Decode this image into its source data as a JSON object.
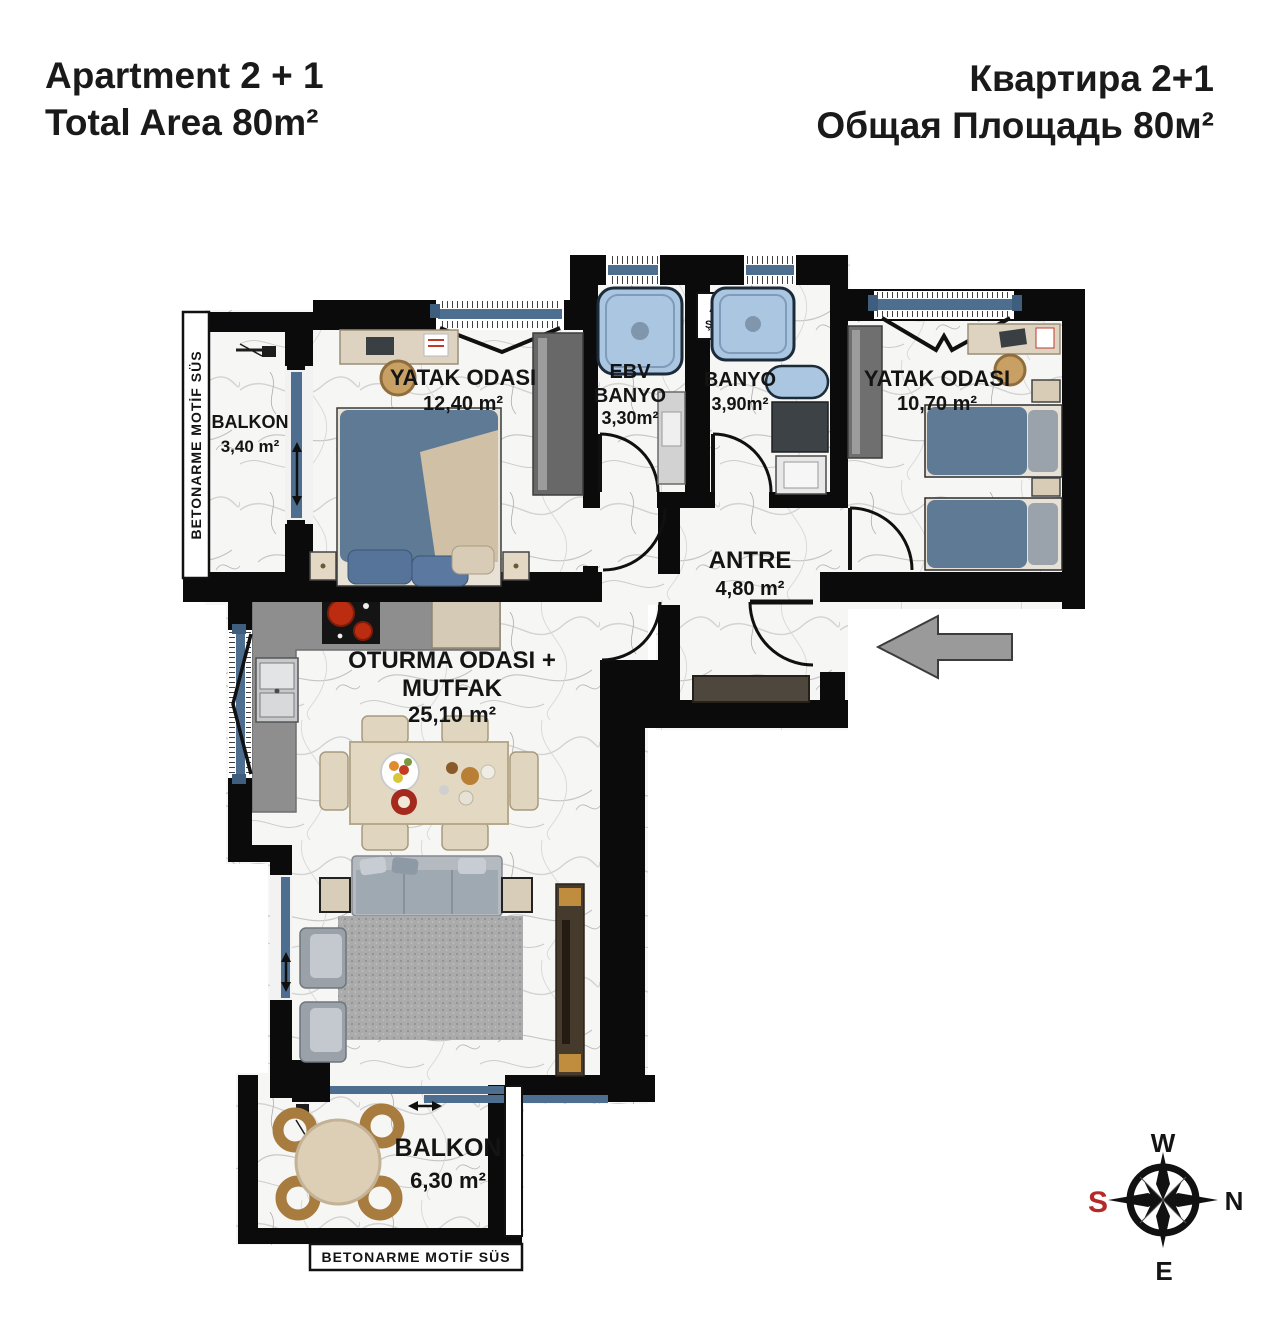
{
  "header": {
    "title_en_line1": "Apartment 2 + 1",
    "title_en_line2": "Total Area 80m²",
    "title_ru_line1": "Квартира 2+1",
    "title_ru_line2": "Общая Площадь 80м²"
  },
  "rooms": {
    "balcony_top": {
      "name": "BALKON",
      "area": "3,40 m²"
    },
    "bedroom_left": {
      "name": "YATAK ODASI",
      "area": "12,40 m²"
    },
    "ensuite_bath": {
      "line1": "EBV",
      "line2": "BANYO",
      "area": "3,30m²"
    },
    "bath": {
      "name": "BANYO",
      "area": "3,90m²"
    },
    "bedroom_right": {
      "name": "YATAK ODASI",
      "area": "10,70 m²"
    },
    "hallway": {
      "name": "ANTRE",
      "area": "4,80 m²"
    },
    "living_kitchen": {
      "line1": "OTURMA ODASI +",
      "line2": "MUTFAK",
      "area": "25,10 m²"
    },
    "balcony_bottom": {
      "name": "BALKON",
      "area": "6,30 m²"
    }
  },
  "decor": {
    "strip_left": "BETONARME MOTİF SÜS",
    "strip_bottom": "BETONARME MOTİF SÜS",
    "shaft_line1": "AT",
    "shaft_line2": "ŞAF"
  },
  "compass": {
    "top": "W",
    "right": "N",
    "left": "S",
    "bottom": "E"
  },
  "colors": {
    "wall": "#0b0b0b",
    "window_blue": "#4d6e8f",
    "shower_blue": "#abc6e0",
    "bed_blue": "#5e7a94",
    "arrow_gray": "#9a9a9a",
    "south_red": "#b42a28"
  }
}
